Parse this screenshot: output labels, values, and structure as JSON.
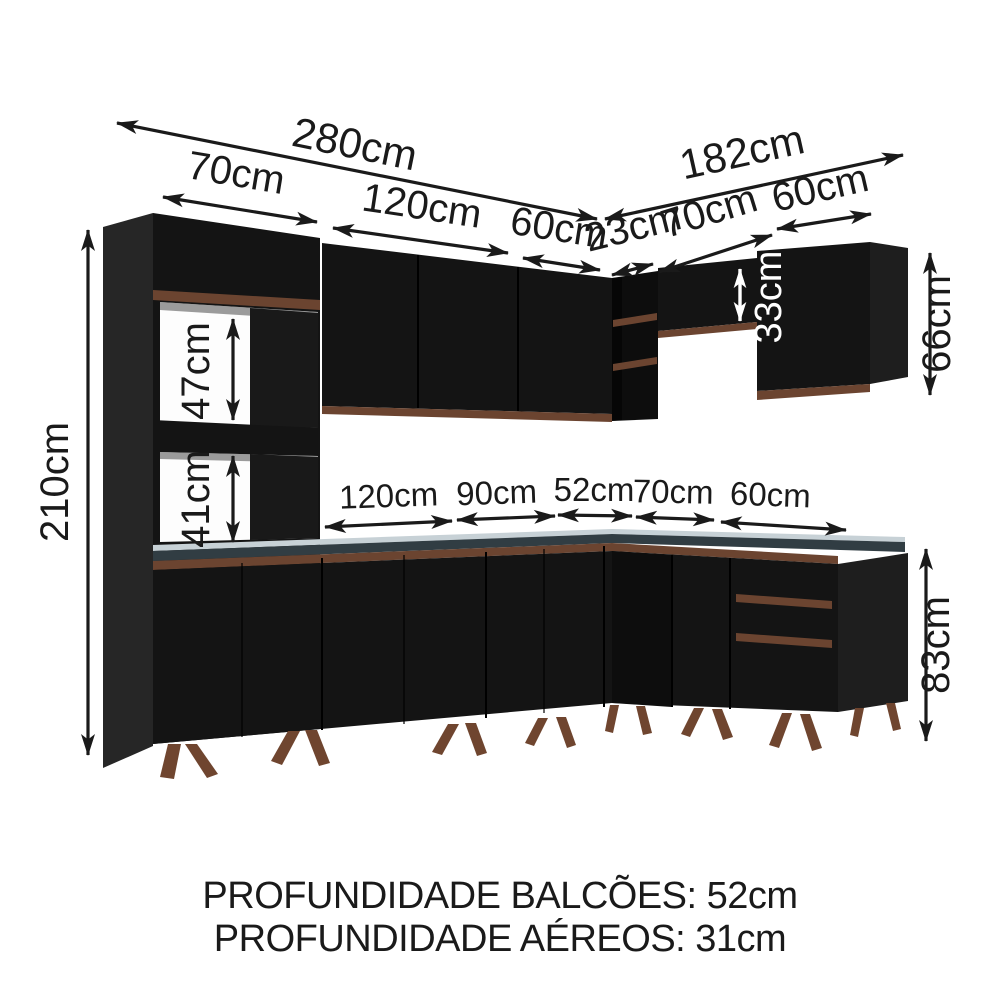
{
  "figure_type": "kitchen-cabinet-dimension-diagram",
  "dims": {
    "left_total": "280cm",
    "right_total": "182cm",
    "tower_w": "70cm",
    "upper_l1": "120cm",
    "upper_l2": "60cm",
    "corner": "23cm",
    "upper_r1": "70cm",
    "upper_r2": "60cm",
    "base_l1": "120cm",
    "base_l2": "90cm",
    "base_c": "52cm",
    "base_r1": "70cm",
    "base_r2": "60cm",
    "height_total": "210cm",
    "niche1": "47cm",
    "niche2": "41cm",
    "bridge_h": "33cm",
    "wall_h": "66cm",
    "base_h": "83cm"
  },
  "footer": {
    "balcoes": "PROFUNDIDADE BALCÕES: 52cm",
    "aereos": "PROFUNDIDADE AÉREOS: 31cm"
  },
  "colors": {
    "cabinet": "#141414",
    "cabinet_side": "#262626",
    "wood": "#6b4430",
    "leg": "#6f452f",
    "ctop": "#5f707b",
    "cedge": "#313d43",
    "text": "#1a1a1a",
    "text_inverse": "#ffffff",
    "background": "#ffffff"
  }
}
